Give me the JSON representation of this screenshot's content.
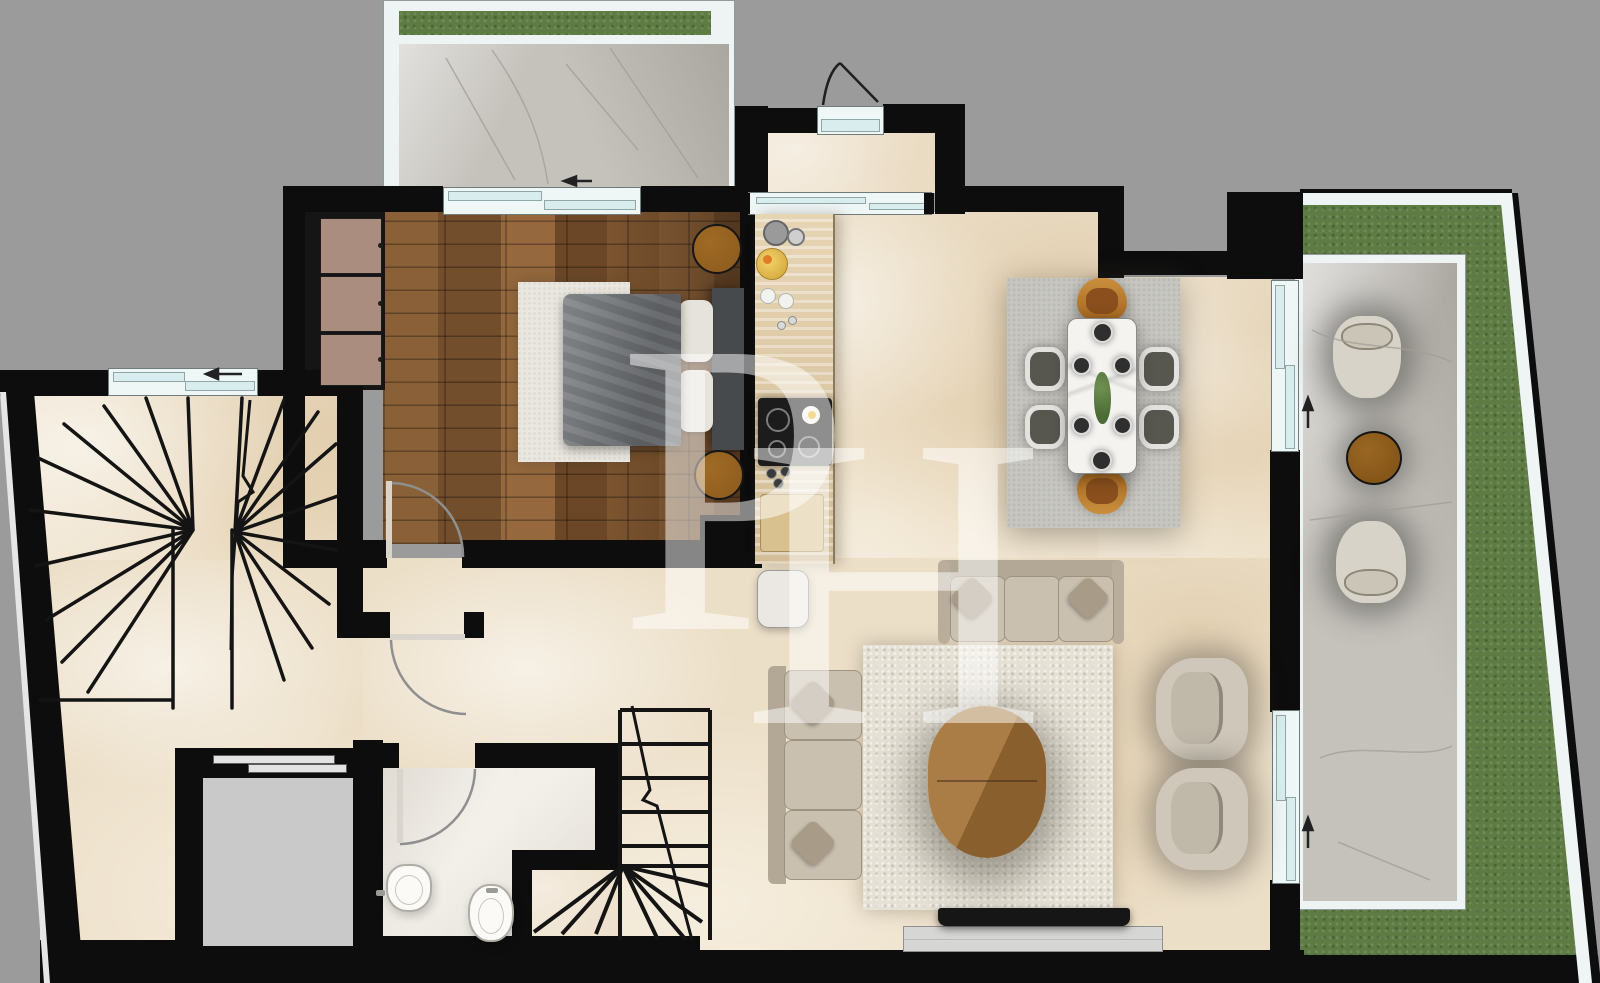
{
  "meta": {
    "kind": "architectural floor plan, top-down 3d render",
    "width": 1600,
    "height": 983
  },
  "watermark": {
    "letters": [
      "P",
      "H"
    ]
  },
  "colors": {
    "background": "#9b9b9b",
    "wall": "#0d0d0d",
    "floor-beige": "#ecdfc8",
    "floor-wood-a": "#8a6038",
    "bath-marble": "#f3f0ea",
    "terrace-marble": "#c5c2bc",
    "grass": "#5d7b42",
    "railing-white": "#edf4f3",
    "window-frame": "#eef6f6",
    "window-glass": "#d9edef",
    "elevator-cab": "#c9c9c9",
    "rug-dining": "#c7c6c0",
    "rug-living": "#e6e1d5",
    "rug-bed": "#eae7e0",
    "sofa-body": "#c9c0b0",
    "sofa-back": "#b3a896",
    "pillow": "#a89c88",
    "lounge-chair": "#cfc8ba",
    "amber-chair": "#a4651f",
    "side-chair-seat": "#57564f",
    "dining-table": "#f4f3f0",
    "coffee-table-a": "#a97d45",
    "coffee-table-b": "#8a5f2e",
    "nightstand": "#8a5a1e",
    "wardrobe-panel": "#ab8d80",
    "counter-wood": "#dcc7a4",
    "cooktop": "#1c1c1c",
    "duvet": "#75787b",
    "headboard": "#474a4c",
    "tv": "#161616",
    "console": "#d6d6d4",
    "outdoor-chair": "#d8d3c8",
    "outdoor-table": "#7d4f16",
    "toilet-white": "#fbfaf7",
    "watermark": "rgba(255,255,255,0.5)"
  },
  "plan": {
    "rooms": [
      "terrace-northwest",
      "entry-vestibule",
      "bedroom",
      "kitchen",
      "dining-area",
      "living-room",
      "hallway",
      "stair-hall",
      "bathroom",
      "elevator-shaft",
      "terrace-east"
    ],
    "furniture": {
      "bedroom": [
        "wardrobe-3-door",
        "double-bed",
        "gray-duvet",
        "pillows",
        "headboard",
        "round-nightstand-north",
        "round-nightstand-south",
        "area-rug"
      ],
      "kitchen": [
        "counter-run",
        "induction-cooktop",
        "fruit-bowl",
        "pans",
        "plates",
        "bottles",
        "cutting-board",
        "stool"
      ],
      "dining-area": [
        "area-rug",
        "marble-dining-table",
        "amber-head-chair-north",
        "amber-head-chair-south",
        "gray-side-chair-1",
        "gray-side-chair-2",
        "gray-side-chair-3",
        "gray-side-chair-4",
        "place-settings-x6",
        "centerpiece-plant"
      ],
      "living-room": [
        "three-seat-sofa-north",
        "three-seat-sofa-west",
        "shag-rug",
        "organic-wood-coffee-table",
        "lounge-chair-1",
        "lounge-chair-2",
        "tv",
        "media-console"
      ],
      "bathroom": [
        "toilet",
        "bidet"
      ],
      "terrace-east": [
        "outdoor-armchair-north",
        "outdoor-armchair-south",
        "round-side-table"
      ]
    },
    "doors": [
      "entry-door",
      "bedroom-door",
      "hallway-door",
      "bathroom-door",
      "kitchen-sliding-door",
      "elevator-sliding-door"
    ],
    "windows": [
      "stair-hall-window",
      "bedroom-terrace-window",
      "dining-window-east",
      "living-window-east"
    ],
    "stairs": [
      "winder-staircase-west",
      "straight-staircase-south"
    ],
    "direction_arrows": [
      "stair-window-arrow-left",
      "terrace-nw-arrow-left",
      "terrace-east-arrow-up-1",
      "terrace-east-arrow-up-2"
    ]
  }
}
